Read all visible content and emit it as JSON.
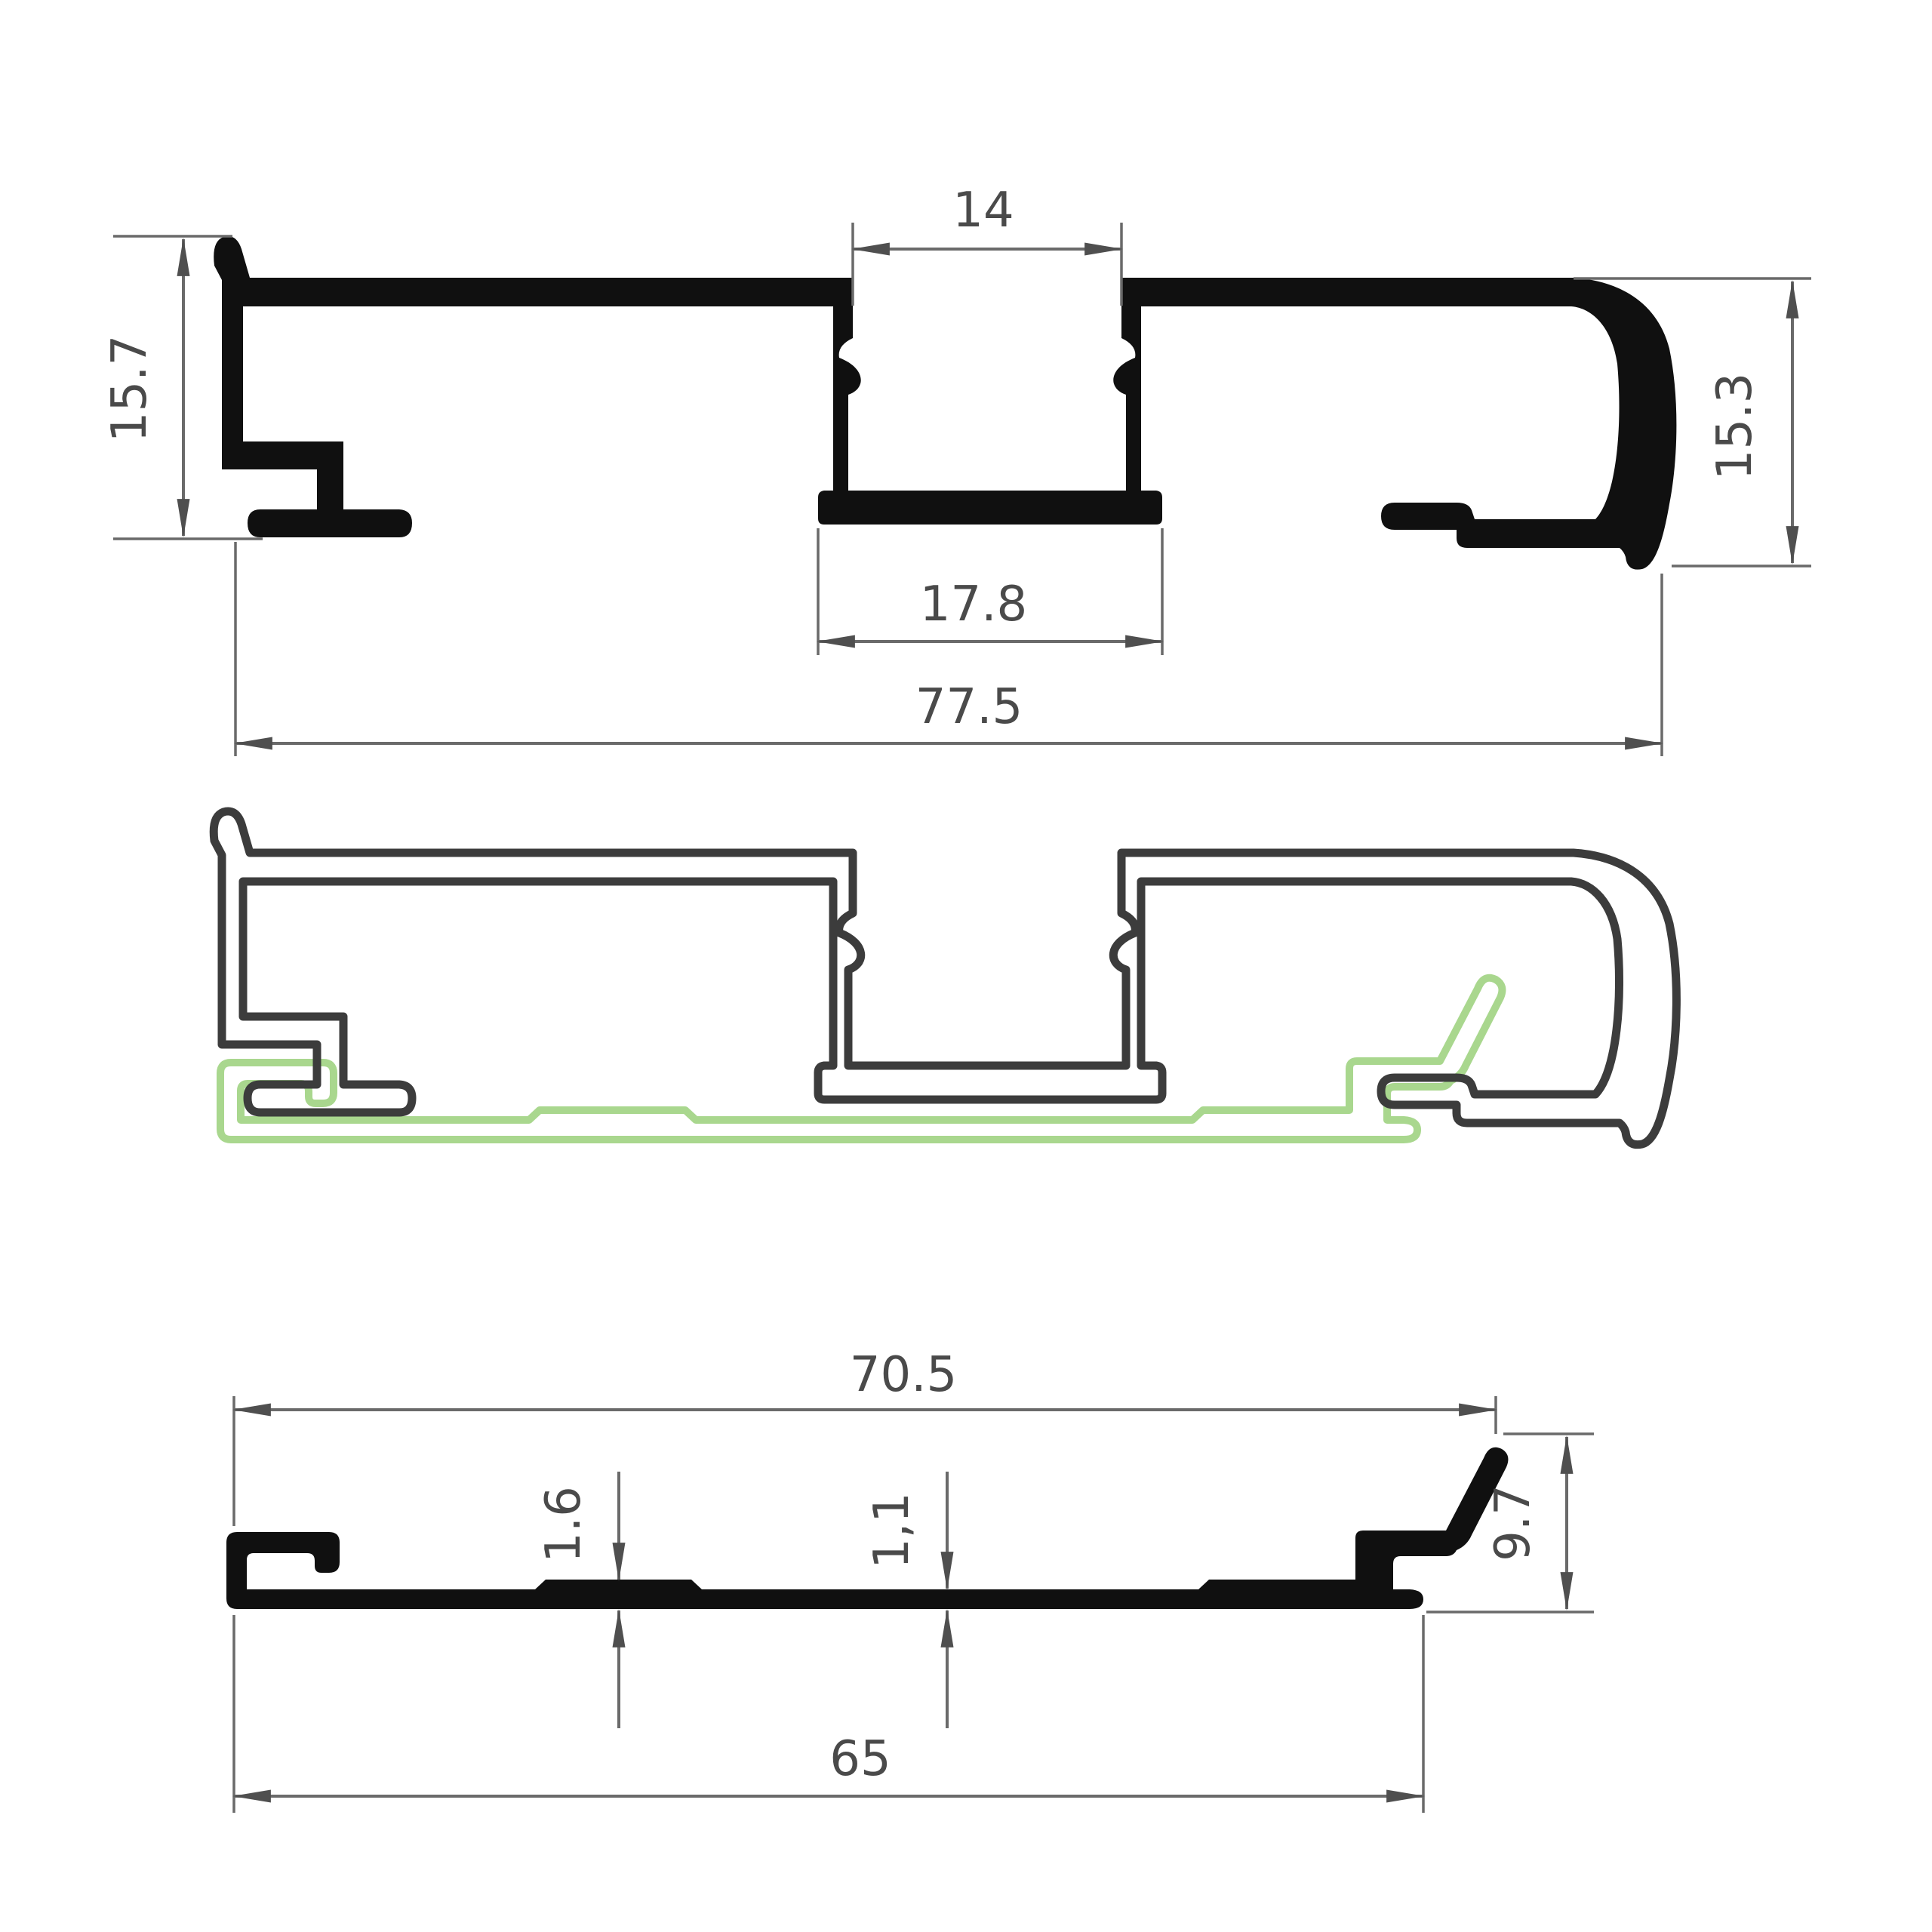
{
  "drawing": {
    "kind": "aluminium-profile-technical-drawing",
    "background": "#ffffff",
    "colors": {
      "profile_fill": "#101010",
      "assembly_outline": "#3c3c3c",
      "gasket_outline": "#a9d78e",
      "dimension_line": "#6a6a6a",
      "dimension_text": "#4a4a4a"
    },
    "views": {
      "top_section": {
        "name": "main profile cross-section (filled)",
        "dims": {
          "channel_top_width": "14",
          "left_height": "15.7",
          "right_height": "15.3",
          "channel_bottom_width": "17.8",
          "overall_width": "77.5"
        }
      },
      "middle_assembly": {
        "name": "assembly view: main profile outline with mating base profile outline"
      },
      "bottom_section": {
        "name": "mating base profile cross-section (filled)",
        "dims": {
          "overall_width": "70.5",
          "pad_thickness": "1.6",
          "sheet_thickness": "1,1",
          "end_height": "9.7",
          "base_width": "65"
        }
      }
    }
  }
}
